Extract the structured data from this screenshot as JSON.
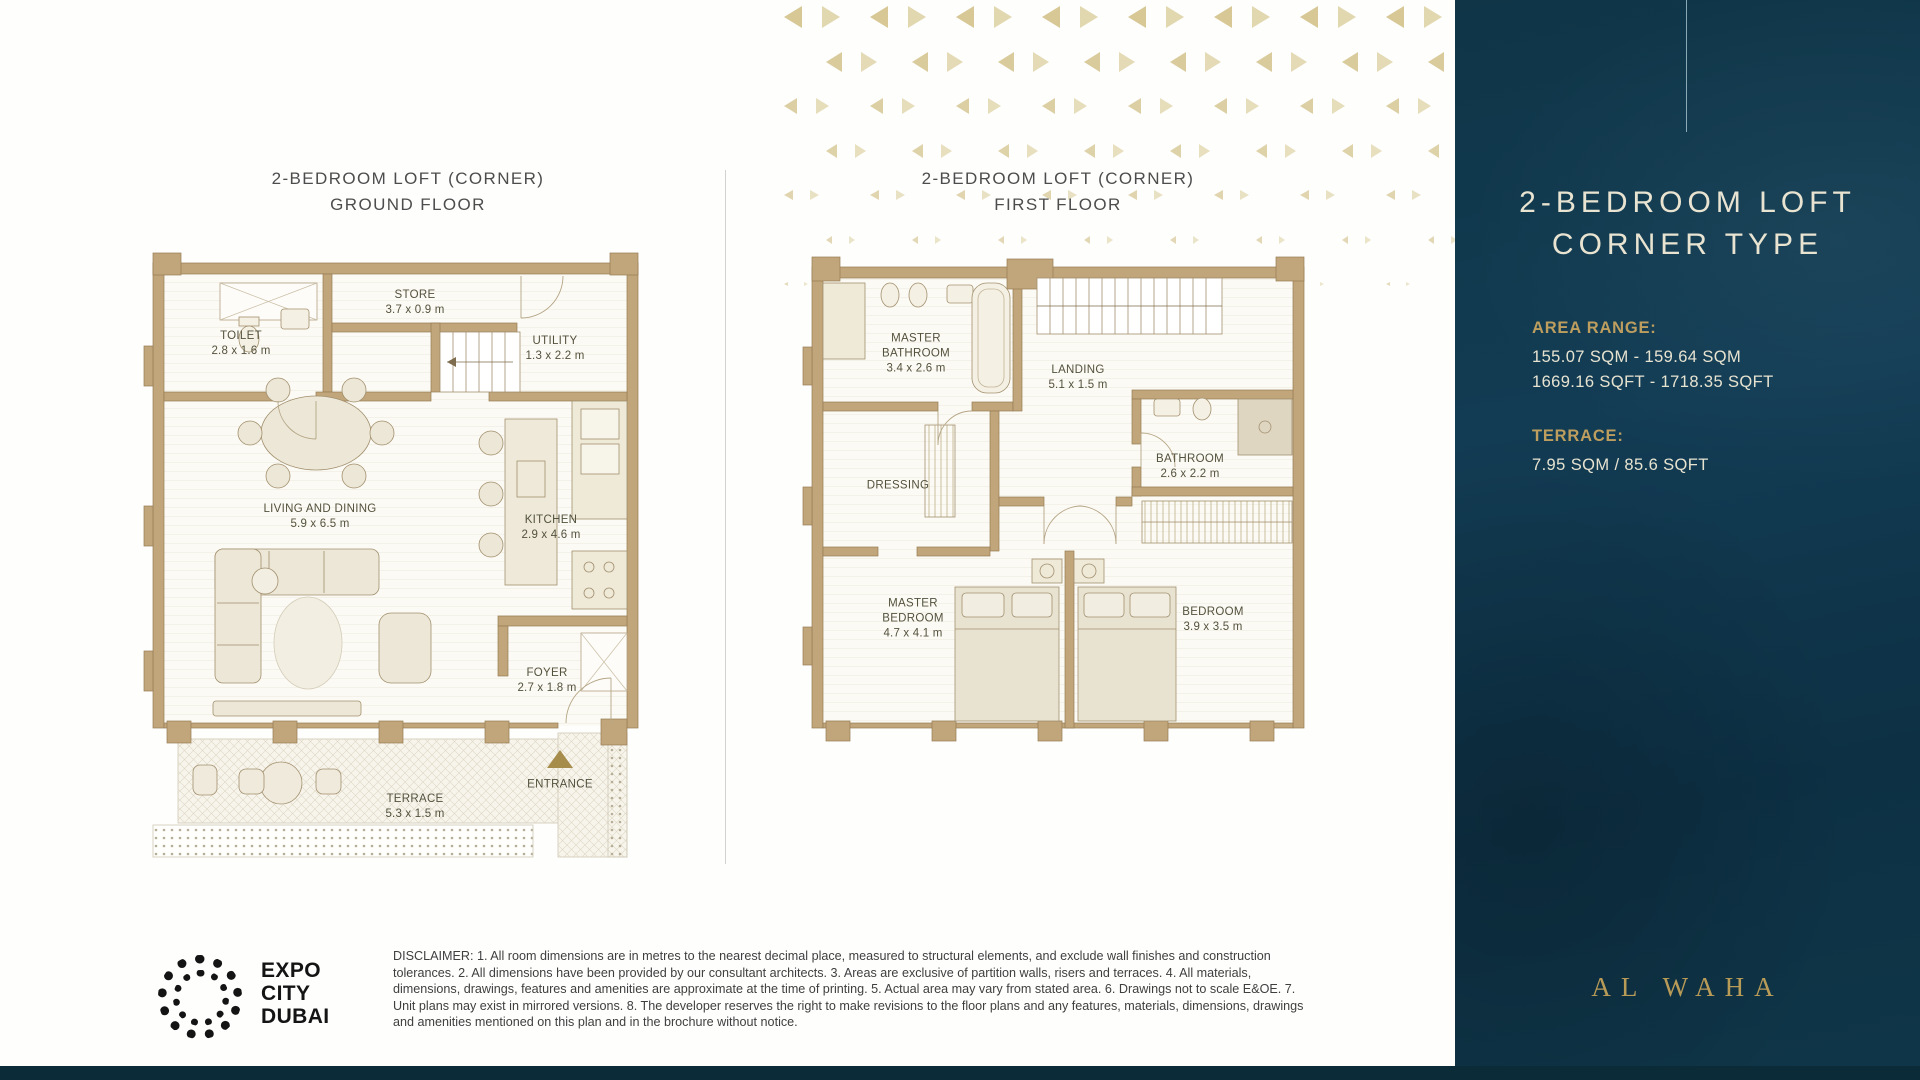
{
  "page": {
    "colors": {
      "sidebar_navy": "#103349",
      "gold_accent": "#bd9e5e",
      "cream_text": "#e9e4d1",
      "wall_tan": "#c1a67b",
      "label_olive": "#53523d",
      "pattern_gold": "#d7c896",
      "pattern_gold_light": "#e2d8b0",
      "entrance_gold": "#a78d4c"
    }
  },
  "ground_floor": {
    "title_line1": "2-BEDROOM LOFT (CORNER)",
    "title_line2": "GROUND FLOOR",
    "rooms": [
      {
        "name": "STORE",
        "dims": "3.7 x 0.9 m"
      },
      {
        "name": "TOILET",
        "dims": "2.8 x 1.6 m"
      },
      {
        "name": "UTILITY",
        "dims": "1.3 x 2.2 m"
      },
      {
        "name": "LIVING AND DINING",
        "dims": "5.9 x 6.5 m"
      },
      {
        "name": "KITCHEN",
        "dims": "2.9 x 4.6 m"
      },
      {
        "name": "FOYER",
        "dims": "2.7 x 1.8 m"
      },
      {
        "name": "TERRACE",
        "dims": "5.3 x 1.5 m"
      }
    ],
    "entrance_label": "ENTRANCE"
  },
  "first_floor": {
    "title_line1": "2-BEDROOM LOFT (CORNER)",
    "title_line2": "FIRST FLOOR",
    "rooms": [
      {
        "name": "MASTER BATHROOM",
        "dims": "3.4 x 2.6 m"
      },
      {
        "name": "LANDING",
        "dims": "5.1 x 1.5 m"
      },
      {
        "name": "DRESSING",
        "dims": ""
      },
      {
        "name": "BATHROOM",
        "dims": "2.6 x 2.2 m"
      },
      {
        "name": "MASTER BEDROOM",
        "dims": "4.7 x 4.1 m"
      },
      {
        "name": "BEDROOM",
        "dims": "3.9 x 3.5 m"
      }
    ]
  },
  "sidebar": {
    "title_line1": "2-BEDROOM LOFT",
    "title_line2": "CORNER TYPE",
    "area_range_label": "AREA RANGE:",
    "area_sqm": "155.07 SQM - 159.64 SQM",
    "area_sqft": "1669.16 SQFT - 1718.35 SQFT",
    "terrace_label": "TERRACE:",
    "terrace_value": "7.95 SQM / 85.6 SQFT",
    "brand_logo": "AL WAHA"
  },
  "footer": {
    "brand_lines": [
      "EXPO",
      "CITY",
      "DUBAI"
    ],
    "disclaimer": "DISCLAIMER: 1. All room dimensions are in metres to the nearest decimal place, measured to structural elements, and exclude wall finishes and construction tolerances. 2. All dimensions have been provided by our consultant architects. 3. Areas are exclusive of partition walls, risers and terraces. 4. All materials, dimensions, drawings, features and amenities are approximate at the time of printing. 5. Actual area may vary from stated area. 6. Drawings not to scale E&OE. 7. Unit plans may exist in mirrored versions. 8. The developer reserves the right to make revisions to the floor plans and any features, materials, dimensions, drawings and amenities mentioned on this plan and in the brochure without notice."
  }
}
